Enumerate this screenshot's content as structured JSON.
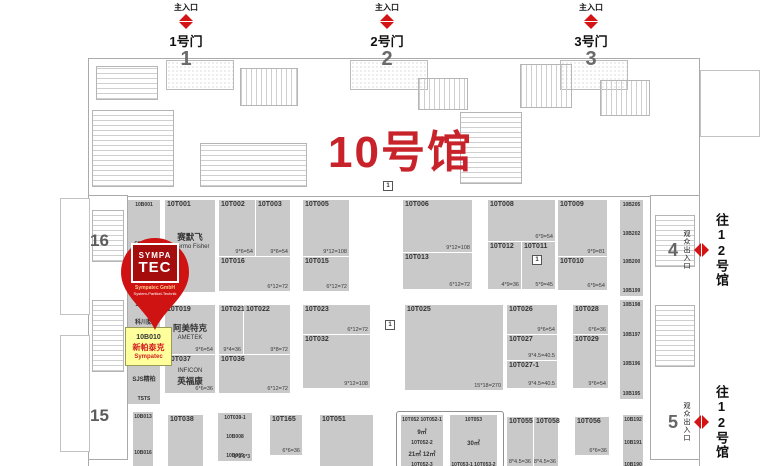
{
  "hall": {
    "title": "10号馆"
  },
  "colors": {
    "accent_red": "#d41414",
    "title_red": "#c8232b",
    "booth_gray": "#c9c9c9",
    "highlight_yellow": "#ffff9c",
    "pin_red": "#ce1312",
    "logo_red": "#a50d0d"
  },
  "top_gates": [
    {
      "entrance_label": "主入口",
      "door_label": "1号门",
      "number": "1",
      "x": 186
    },
    {
      "entrance_label": "主入口",
      "door_label": "2号门",
      "number": "2",
      "x": 387
    },
    {
      "entrance_label": "主入口",
      "door_label": "3号门",
      "number": "3",
      "x": 591
    }
  ],
  "left_gates": [
    {
      "number": "16",
      "x": 90,
      "y": 231
    },
    {
      "number": "15",
      "x": 90,
      "y": 406
    }
  ],
  "right_gates": [
    {
      "number": "4",
      "access": "观众出入口",
      "to_hall": "往12号馆",
      "x": 668,
      "y": 205
    },
    {
      "number": "5",
      "access": "观众出入口",
      "to_hall": "往12号馆",
      "x": 668,
      "y": 377
    }
  ],
  "pin": {
    "logo_line1": "SYMPA",
    "logo_line2": "TEC",
    "company": "Sympatec GmbH",
    "tagline": "System-Partikel-Technik"
  },
  "highlight": {
    "booth_id": "10B010",
    "name_cn": "新帕泰克",
    "name_en": "Sympatec"
  },
  "markers": [
    {
      "label": "1",
      "x": 383,
      "y": 181
    },
    {
      "label": "1",
      "x": 385,
      "y": 320
    },
    {
      "label": "1",
      "x": 532,
      "y": 255
    }
  ],
  "booths": [
    {
      "id": "10T001",
      "sub": [
        "赛默飞",
        "Thermo Fisher"
      ],
      "x": 165,
      "y": 200,
      "w": 50,
      "h": 92
    },
    {
      "id": "10T002",
      "dim": "9*6=54",
      "x": 219,
      "y": 200,
      "w": 36,
      "h": 56
    },
    {
      "id": "10T003",
      "dim": "9*6=54",
      "x": 256,
      "y": 200,
      "w": 34,
      "h": 56
    },
    {
      "id": "10T016",
      "dim": "6*12=72",
      "x": 219,
      "y": 257,
      "w": 71,
      "h": 34
    },
    {
      "id": "10T005",
      "dim": "9*12=108",
      "x": 303,
      "y": 200,
      "w": 46,
      "h": 56
    },
    {
      "id": "10T015",
      "dim": "6*12=72",
      "x": 303,
      "y": 257,
      "w": 46,
      "h": 34
    },
    {
      "id": "10T006",
      "dim": "9*12=108",
      "x": 403,
      "y": 200,
      "w": 69,
      "h": 52
    },
    {
      "id": "10T013",
      "dim": "6*12=72",
      "x": 403,
      "y": 253,
      "w": 69,
      "h": 36
    },
    {
      "id": "10T008",
      "dim": "6*9=54",
      "x": 488,
      "y": 200,
      "w": 67,
      "h": 41
    },
    {
      "id": "10T012",
      "dim": "4*9=36",
      "x": 488,
      "y": 242,
      "w": 33,
      "h": 47
    },
    {
      "id": "10T011",
      "dim": "5*9=45",
      "x": 522,
      "y": 242,
      "w": 33,
      "h": 47
    },
    {
      "id": "10T009",
      "dim": "9*9=81",
      "x": 558,
      "y": 200,
      "w": 49,
      "h": 56
    },
    {
      "id": "10T010",
      "dim": "6*9=54",
      "x": 558,
      "y": 257,
      "w": 49,
      "h": 33
    },
    {
      "id": "10T019",
      "sub": [
        "阿美特克",
        "AMETEK"
      ],
      "dim": "9*6=54",
      "x": 165,
      "y": 305,
      "w": 50,
      "h": 49
    },
    {
      "id": "10T037",
      "sub": [
        "INFICON",
        "英福康"
      ],
      "dim": "6*6=36",
      "x": 165,
      "y": 355,
      "w": 50,
      "h": 38
    },
    {
      "id": "10T021",
      "dim": "9*4=36",
      "x": 219,
      "y": 305,
      "w": 24,
      "h": 49
    },
    {
      "id": "10T022",
      "dim": "9*8=72",
      "x": 244,
      "y": 305,
      "w": 46,
      "h": 49
    },
    {
      "id": "10T036",
      "dim": "6*12=72",
      "x": 219,
      "y": 355,
      "w": 71,
      "h": 38
    },
    {
      "id": "10T023",
      "dim": "6*12=72",
      "x": 303,
      "y": 305,
      "w": 67,
      "h": 29
    },
    {
      "id": "10T032",
      "dim": "9*12=108",
      "x": 303,
      "y": 335,
      "w": 67,
      "h": 53
    },
    {
      "id": "10T025",
      "dim": "15*18=270",
      "x": 405,
      "y": 305,
      "w": 98,
      "h": 85
    },
    {
      "id": "10T026",
      "dim": "9*6=54",
      "x": 507,
      "y": 305,
      "w": 50,
      "h": 29
    },
    {
      "id": "10T027",
      "dim": "9*4.5=40.5",
      "x": 507,
      "y": 335,
      "w": 50,
      "h": 25
    },
    {
      "id": "10T027-1",
      "dim": "9*4.5=40.5",
      "x": 507,
      "y": 361,
      "w": 50,
      "h": 27
    },
    {
      "id": "10T028",
      "dim": "6*6=36",
      "x": 573,
      "y": 305,
      "w": 35,
      "h": 29
    },
    {
      "id": "10T029",
      "dim": "9*6=54",
      "x": 573,
      "y": 335,
      "w": 35,
      "h": 53
    },
    {
      "id": "10T038",
      "x": 168,
      "y": 415,
      "w": 35,
      "h": 51
    },
    {
      "id": "10T039-1",
      "lines": [
        "10T039-1",
        "10B008",
        "10B009"
      ],
      "dim": "6*3  6*3",
      "x": 218,
      "y": 413,
      "w": 34,
      "h": 44
    },
    {
      "id": "10T165",
      "dim": "6*6=36",
      "x": 270,
      "y": 415,
      "w": 32,
      "h": 40
    },
    {
      "id": "10T051",
      "x": 320,
      "y": 415,
      "w": 53,
      "h": 51
    },
    {
      "id": "10T052",
      "lines": [
        "10T052 10T052-1",
        "9㎡",
        "10T052-2",
        "21㎡  12㎡",
        "10T052-3"
      ],
      "x": 401,
      "y": 415,
      "w": 42,
      "h": 51
    },
    {
      "id": "10T053",
      "lines": [
        "10T053",
        "30㎡",
        "10T053-1 10T053-2"
      ],
      "x": 450,
      "y": 415,
      "w": 47,
      "h": 51
    },
    {
      "id": "10T055",
      "dim": "8*4.5=36",
      "x": 507,
      "y": 417,
      "w": 26,
      "h": 49
    },
    {
      "id": "10T058",
      "dim": "8*4.5=36",
      "x": 534,
      "y": 417,
      "w": 24,
      "h": 49
    },
    {
      "id": "10T056",
      "dim": "6*6=36",
      "x": 575,
      "y": 417,
      "w": 34,
      "h": 38
    }
  ],
  "strip_booths": [
    {
      "lines": [
        "10B001",
        "cenotec"
      ],
      "x": 128,
      "y": 200,
      "w": 32,
      "h": 44
    },
    {
      "lines": [],
      "x": 128,
      "y": 246,
      "w": 32,
      "h": 50
    },
    {
      "lines": [
        "10B006",
        "科川数"
      ],
      "x": 128,
      "y": 300,
      "w": 32,
      "h": 24
    },
    {
      "lines": [],
      "x": 128,
      "y": 326,
      "w": 32,
      "h": 30
    },
    {
      "lines": [
        "10B011"
      ],
      "x": 128,
      "y": 358,
      "w": 32,
      "h": 12
    },
    {
      "lines": [
        "SJS精柏",
        "TSTS"
      ],
      "x": 128,
      "y": 372,
      "w": 32,
      "h": 28
    },
    {
      "lines": [
        "10B013"
      ],
      "x": 133,
      "y": 412,
      "w": 20,
      "h": 32
    },
    {
      "lines": [
        "10B016"
      ],
      "x": 133,
      "y": 448,
      "w": 20,
      "h": 18
    },
    {
      "lines": [
        "10B205",
        "10B202",
        "10B200",
        "10B199"
      ],
      "x": 620,
      "y": 200,
      "w": 23,
      "h": 92
    },
    {
      "lines": [
        "10B198",
        "10B197",
        "10B196",
        "10B195"
      ],
      "x": 620,
      "y": 300,
      "w": 23,
      "h": 95
    },
    {
      "lines": [
        "10B192",
        "10B191",
        "10B190"
      ],
      "x": 623,
      "y": 415,
      "w": 20,
      "h": 51
    }
  ]
}
